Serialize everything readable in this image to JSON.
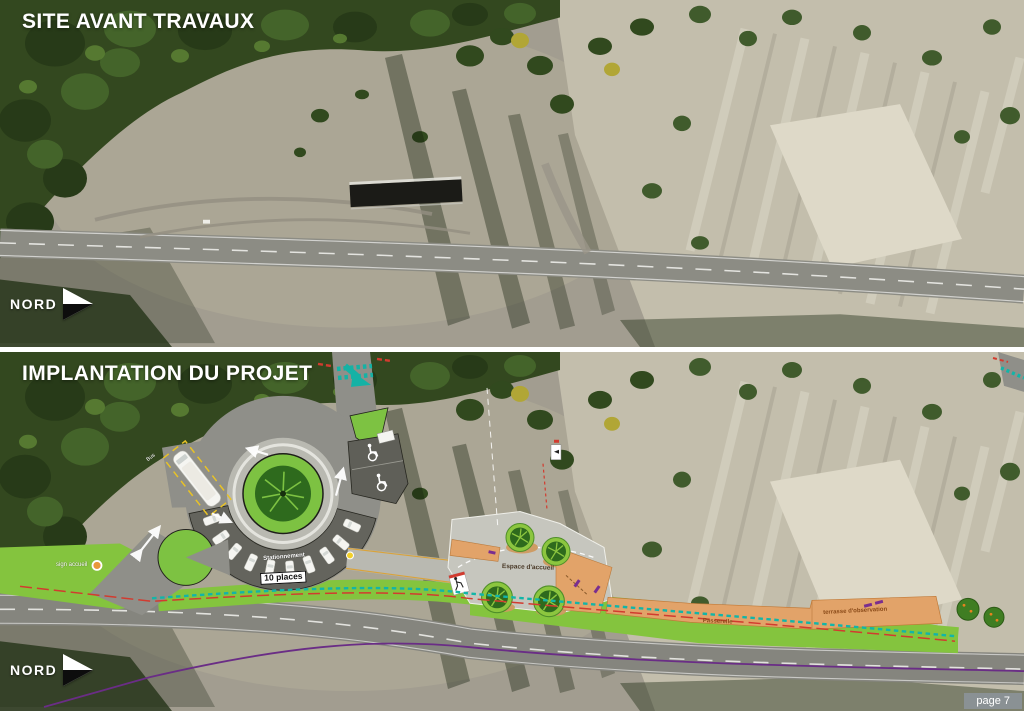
{
  "page_badge": "page 7",
  "panels": {
    "before": {
      "title": "SITE AVANT TRAVAUX",
      "north": "NORD"
    },
    "project": {
      "title": "IMPLANTATION DU PROJET",
      "north": "NORD"
    }
  },
  "plan_labels": {
    "bus": "Bus",
    "parking_row": "Stationnement",
    "parking_count": "10 places",
    "welcome_sign": "sign accueil",
    "welcome_area": "Espace d'accueil",
    "footbridge": "Passerelle",
    "observation_terrace": "terrasse d'observation"
  },
  "legend_colors": {
    "lawn": "#84c43e",
    "asphalt": "#8f8f89",
    "wood_deck": "#e2a369",
    "pedestrian_teal": "#12b5a8",
    "limit_red": "#d23b2f",
    "boundary_purple": "#6a2d86",
    "bench_purple": "#7a2e8f"
  }
}
